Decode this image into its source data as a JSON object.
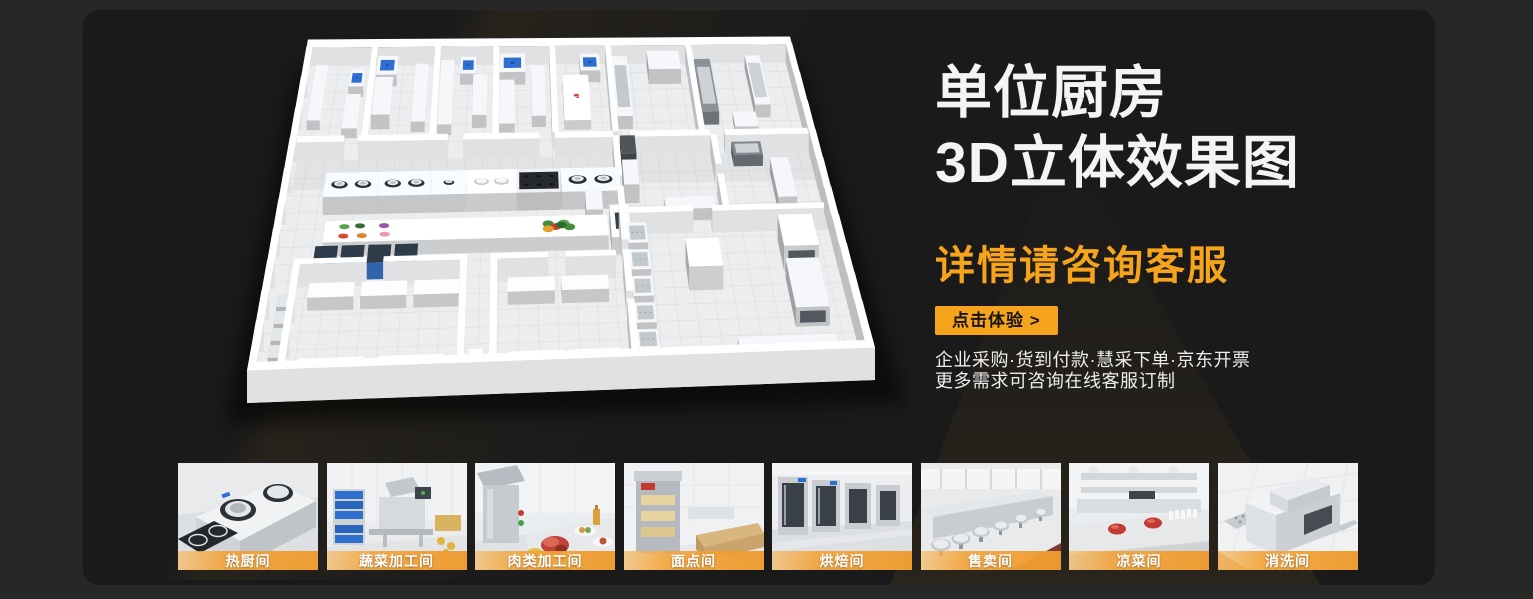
{
  "hero": {
    "title_line1": "单位厨房",
    "title_line2": "3D立体效果图",
    "subtitle": "详情请咨询客服",
    "cta_label": "点击体验 >",
    "note_line1": "企业采购·货到付款·慧采下单·京东开票",
    "note_line2": "更多需求可咨询在线客服订制"
  },
  "thumbnails": [
    {
      "label": "热厨间"
    },
    {
      "label": "蔬菜加工间"
    },
    {
      "label": "肉类加工间"
    },
    {
      "label": "面点间"
    },
    {
      "label": "烘焙间"
    },
    {
      "label": "售卖间"
    },
    {
      "label": "凉菜间"
    },
    {
      "label": "消洗间"
    }
  ],
  "colors": {
    "accent_orange": "#F7A41D",
    "subtitle_orange": "#F6A41C",
    "panel_bg": "#1A1A1A",
    "outer_bg": "#272727",
    "heading_white": "#F4F4F4",
    "thumb_label_orange": "#EE9A2E"
  }
}
